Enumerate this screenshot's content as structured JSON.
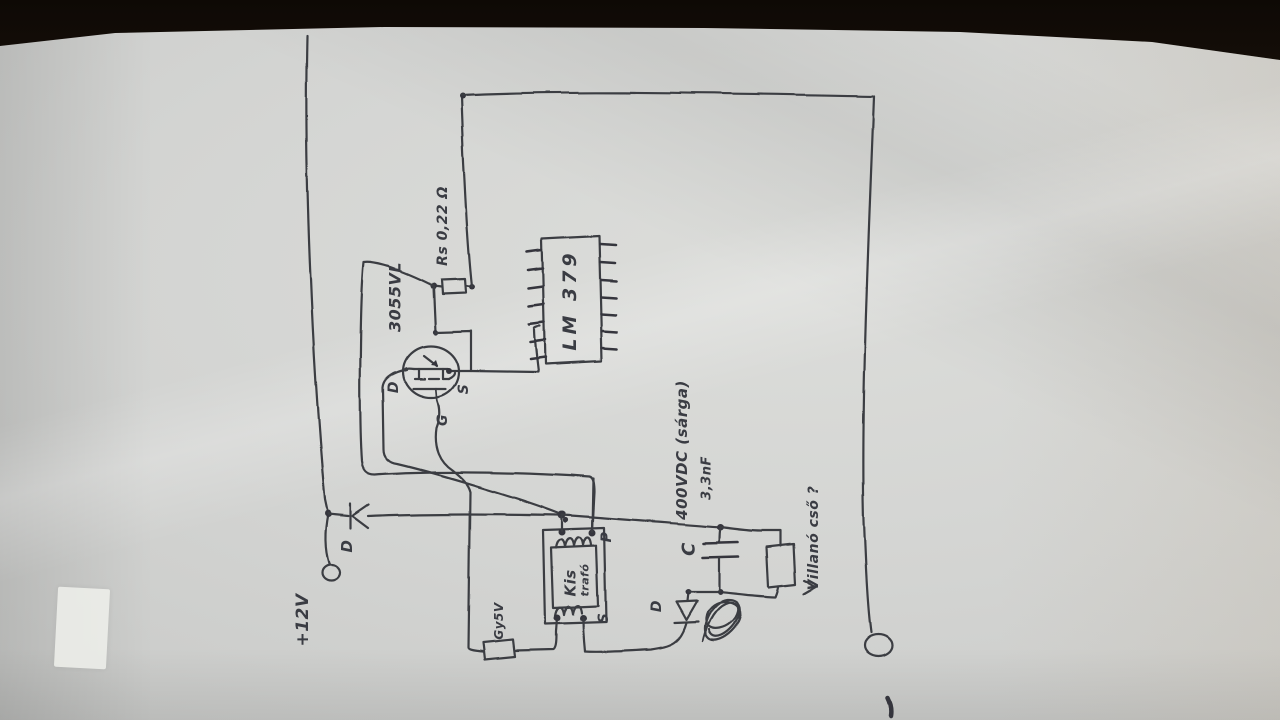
{
  "scene": {
    "description": "Photo of a hand-drawn flash-charger circuit schematic on white paper (drawing rotated 90°)",
    "ink_color": "#3a3c42",
    "paper_color": "#d3d4d2",
    "background_color": "#241a10"
  },
  "labels": {
    "supply": "+12V",
    "input_diode": "D",
    "sense_resistor": "Rs 0,22 Ω",
    "transistor": "3055VL",
    "drain": "D",
    "source": "S",
    "gate": "G",
    "ic": "LM 379",
    "transformer_line1": "Kis",
    "transformer_line2": "trafó",
    "primary": "P",
    "secondary": "S",
    "gate_box": "Gy5V",
    "capacitor": "C",
    "cap_voltage": "400VDC (sárga)",
    "cap_value": "3,3nF",
    "secondary_diode": "D",
    "flash_tube": "Villanó cső ?"
  }
}
